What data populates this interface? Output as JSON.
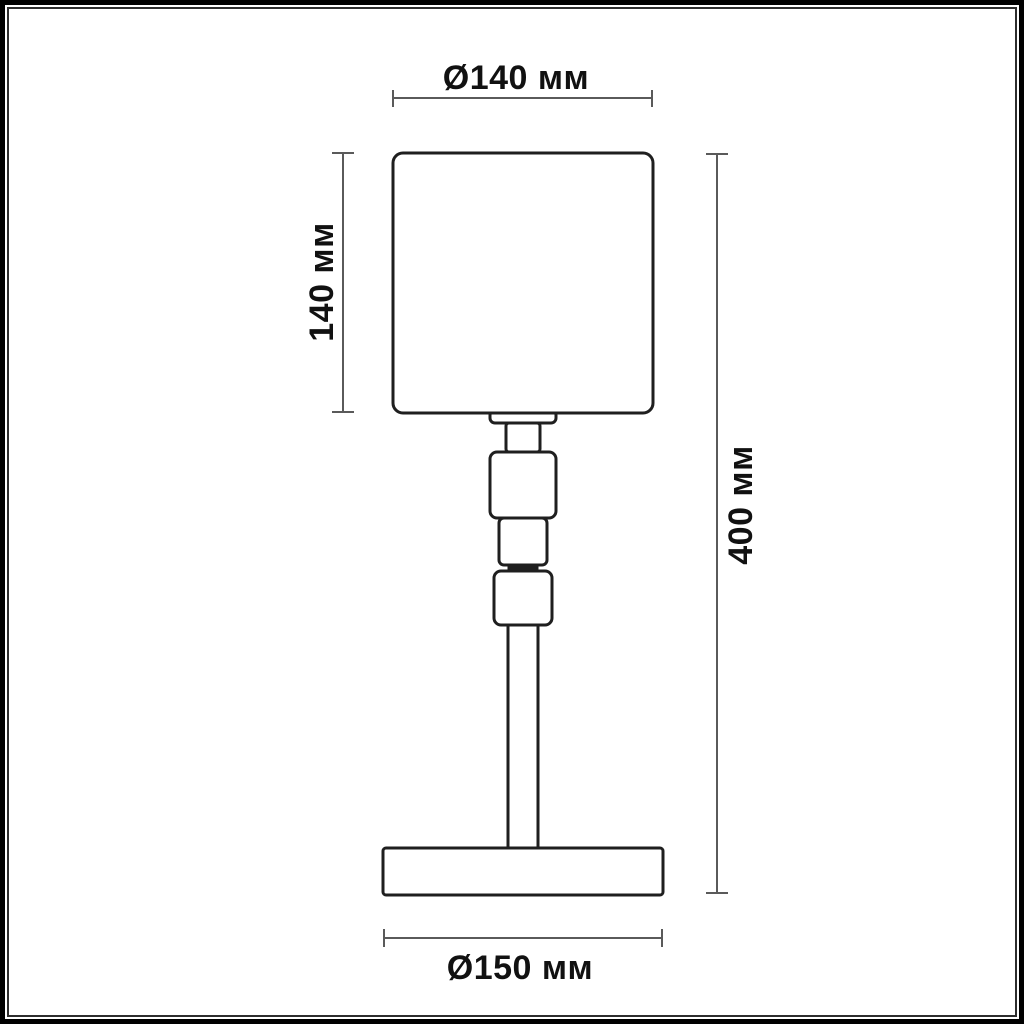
{
  "drawing": {
    "kind": "technical-dimension-drawing",
    "subject": "table-lamp-front-view",
    "colors": {
      "background": "#ffffff",
      "frame_outer": "#000000",
      "frame_inner": "#2e2e2e",
      "lamp_outline": "#1f1f1f",
      "dimension_lines": "#5a5a5a",
      "dimension_text": "#111111"
    },
    "dimensions": {
      "shade_diameter": {
        "label": "Ø140 мм"
      },
      "shade_height": {
        "label": "140 мм"
      },
      "total_height": {
        "label": "400 мм"
      },
      "base_diameter": {
        "label": "Ø150 мм"
      }
    },
    "parts": [
      "lampshade",
      "shade-fitting-tab",
      "neck",
      "upper-joint",
      "middle-joint",
      "joint-connector",
      "lower-joint",
      "stem",
      "base"
    ]
  }
}
